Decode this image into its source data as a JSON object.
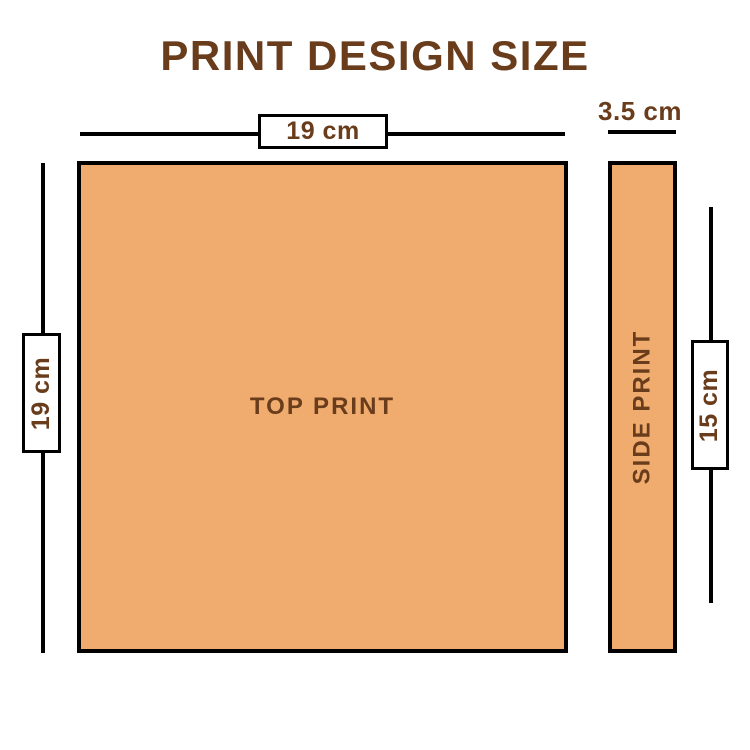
{
  "title": {
    "text": "PRINT DESIGN SIZE"
  },
  "top_print": {
    "label": "TOP PRINT",
    "width": "19 cm",
    "height": "19 cm"
  },
  "side_print": {
    "label": "SIDE PRINT",
    "width": "3.5 cm",
    "height": "15 cm"
  },
  "colors": {
    "bg": "#ffffff",
    "fill": "#F0AC6E",
    "ink": "#693C1C",
    "line": "#000000"
  }
}
